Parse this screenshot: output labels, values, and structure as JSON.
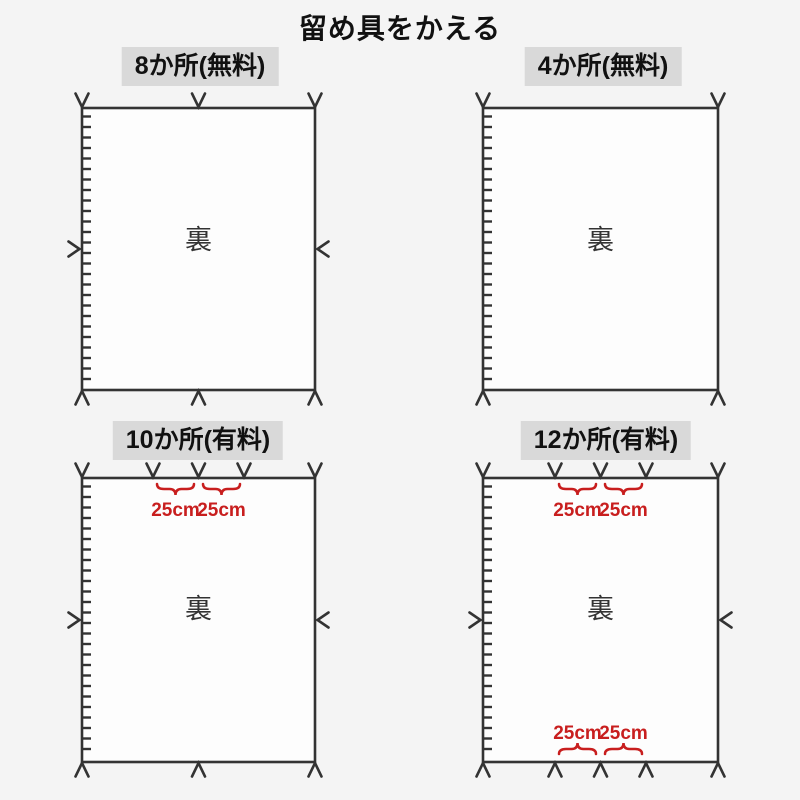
{
  "title": "留め具をかえる",
  "labels": {
    "back": "裏",
    "measurement": "25cm"
  },
  "colors": {
    "accent_red": "#c81e1e",
    "line_dark": "#333333",
    "header_bg": "#d9d9d9",
    "page_bg": "#f4f4f4",
    "sheet_fill": "#fdfdfd"
  },
  "panels": [
    {
      "header": "8か所(無料)",
      "back_label": "裏"
    },
    {
      "header": "4か所(無料)",
      "back_label": "裏"
    },
    {
      "header": "10か所(有料)",
      "back_label": "裏",
      "top_measurements": [
        "25cm",
        "25cm"
      ]
    },
    {
      "header": "12か所(有料)",
      "back_label": "裏",
      "top_measurements": [
        "25cm",
        "25cm"
      ],
      "bottom_measurements": [
        "25cm",
        "25cm"
      ]
    }
  ]
}
